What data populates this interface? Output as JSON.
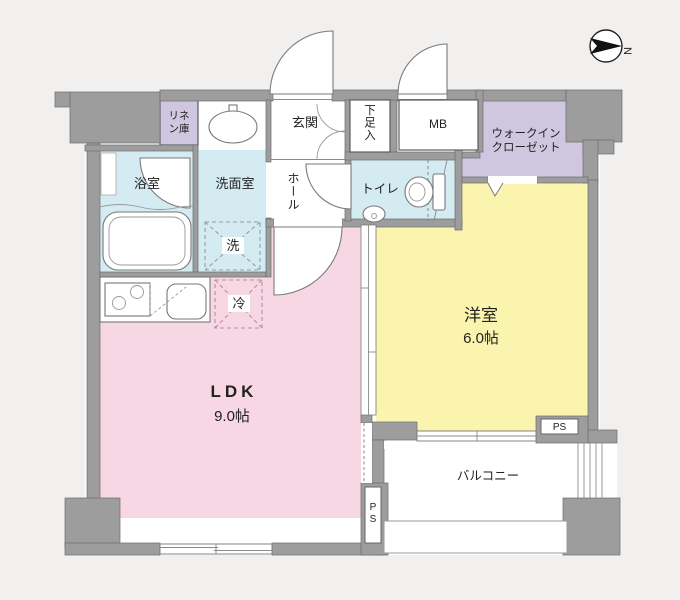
{
  "palette": {
    "background": "#f1f0ee",
    "floor": "#ffffff",
    "wall": "#9d9d9d",
    "wall_edge": "#6b6b6b",
    "ldk_pink": "#f8d7e4",
    "room_yellow": "#faf4af",
    "wet_blue": "#d4ebf1",
    "closet_purple": "#cfc6e0",
    "washer_dash": "#8ba2ad",
    "fridge_dash": "#b7909f"
  },
  "compass": {
    "label": "N"
  },
  "rooms": {
    "ldk": {
      "name": "LDK",
      "size": "9.0帖"
    },
    "western_room": {
      "name": "洋室",
      "size": "6.0帖"
    },
    "balcony": {
      "name": "バルコニー"
    },
    "entrance": {
      "name": "玄関"
    },
    "hall": {
      "name": "ホール"
    },
    "toilet": {
      "name": "トイレ"
    },
    "bathroom": {
      "name": "浴室"
    },
    "washroom": {
      "name": "洗面室"
    },
    "linen": {
      "line1": "リネ",
      "line2": "ン庫"
    },
    "shoe_box": {
      "name": "下足入"
    },
    "meter_box": {
      "name": "MB"
    },
    "walk_in_closet": {
      "line1": "ウォークイン",
      "line2": "クローゼット"
    },
    "washer": {
      "name": "洗"
    },
    "fridge": {
      "name": "冷"
    },
    "pipe_space_bottom": {
      "name": "PS"
    },
    "pipe_space_right": {
      "name": "PS"
    }
  }
}
